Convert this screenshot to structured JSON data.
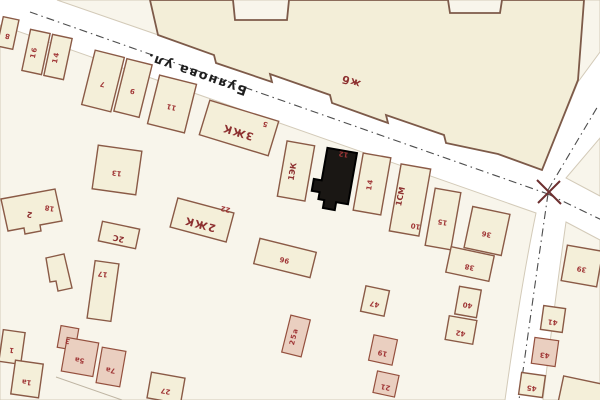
{
  "map": {
    "street_name": "Буянова ул.",
    "labels": {
      "zhb": "жб",
      "zhk3": "3ЖК",
      "zhk2": "2ЖК",
      "ek1": "1ЭК",
      "sm1": "1СМ",
      "s2c": "2С",
      "b2": "2"
    },
    "numbers": {
      "tiny": "8",
      "rowA": "16",
      "rowB": "14",
      "tallA": "7",
      "tallB": "9",
      "b11": "11",
      "zhk3c": "5",
      "sq": "13",
      "black": "12",
      "narrow": "14",
      "sm": "10",
      "b15": "15",
      "b2r": "18",
      "zhk2c": "22",
      "v17": "17",
      "n96": "96",
      "w36": "36",
      "w38": "38",
      "w40": "40",
      "w42": "42",
      "c47": "47",
      "c19": "19",
      "c21": "21",
      "c25a": "25а",
      "bl3": "3",
      "bl5": "5а",
      "bl7": "7а",
      "c1": "1",
      "c2": "1а",
      "b27": "27",
      "e39": "39",
      "e41": "41",
      "e43": "43",
      "e45": "45"
    },
    "colors": {
      "building_fill": "#f4efd9",
      "building_outline": "#8a5a46",
      "label_red": "#a03636",
      "selected_building": "#1a1714",
      "street_name_color": "#1f1f1f",
      "block_fill": "#f8f5eb"
    }
  }
}
